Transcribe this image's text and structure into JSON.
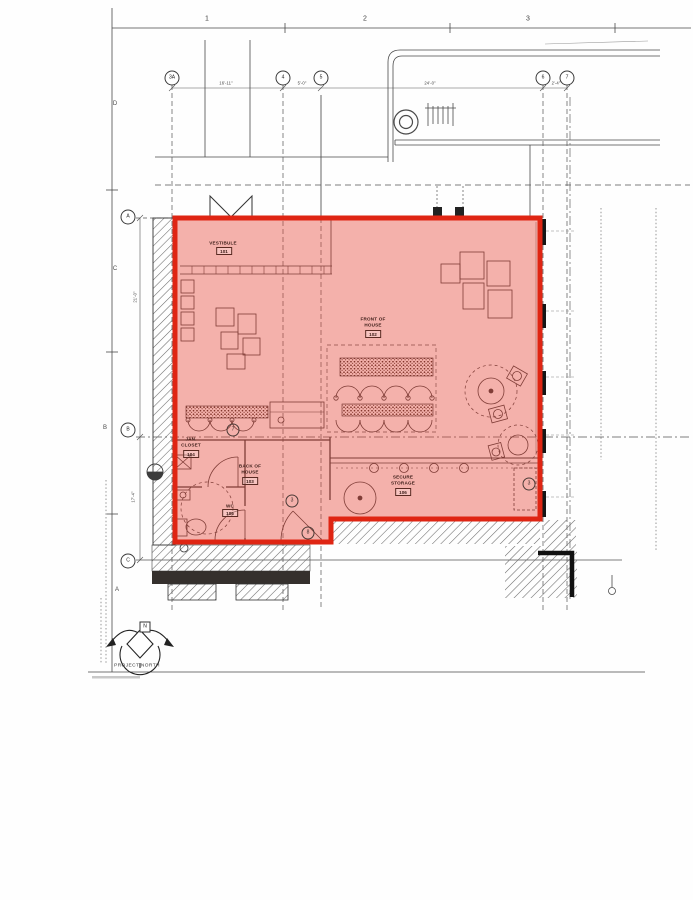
{
  "sheet": {
    "ruler_numbers": [
      "1",
      "2",
      "3"
    ],
    "border_letters": [
      "D",
      "C",
      "B",
      "A"
    ]
  },
  "grid": {
    "top_bubbles": [
      "3A",
      "4",
      "5",
      "6",
      "7"
    ],
    "left_bubbles": [
      "A",
      "B",
      "C"
    ],
    "top_dimensions": [
      "16'-11\"",
      "5'-0\"",
      "24'-0\"",
      "2'-4\""
    ],
    "left_dimensions": [
      "21'-0\"",
      "17'-4\""
    ]
  },
  "rooms": [
    {
      "name": "VESTIBULE",
      "number": "101"
    },
    {
      "name": "FRONT OF HOUSE",
      "number": "102"
    },
    {
      "name": "BACK OF HOUSE",
      "number": "103"
    },
    {
      "name": "JAN. CLOSET",
      "number": "104"
    },
    {
      "name": "WC",
      "number": "105"
    },
    {
      "name": "SECURE STORAGE",
      "number": "106"
    }
  ],
  "keynotes": [
    "7",
    "3",
    "8",
    "3"
  ],
  "north": {
    "label": "PROJECT NORTH",
    "letter": "N"
  },
  "colors": {
    "highlight_fill": "rgba(230,62,48,0.40)",
    "highlight_stroke": "#df2513",
    "line": "#3c3c3c"
  }
}
